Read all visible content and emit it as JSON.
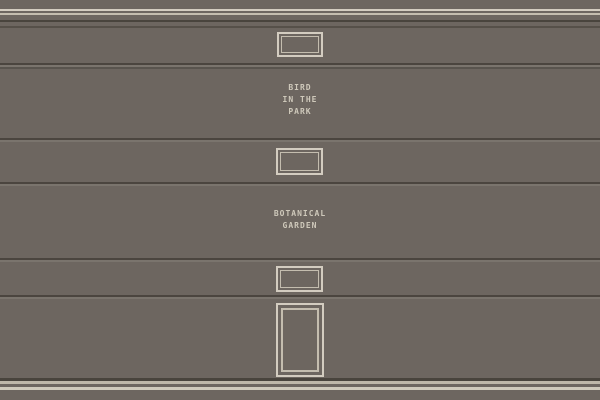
{
  "scene": {
    "description": "pixel-art building facade wall with windows, door and painted signs"
  },
  "signs": {
    "bird": {
      "lines": [
        "BIRD",
        "IN THE",
        "PARK"
      ]
    },
    "garden": {
      "lines": [
        "BOTANICAL",
        "GARDEN"
      ]
    }
  },
  "objects": {
    "window_top": "window-frame",
    "window_middle": "window-frame",
    "window_lower": "window-frame",
    "door": "entrance-door"
  },
  "colors": {
    "wall": "#6d6660",
    "trim_light": "#d3ccc0",
    "trim_mid": "#c4bdaf",
    "line_dark": "#49443d",
    "line_shadow": "#565049",
    "seam_dark": "#4b453f",
    "seam_light": "#7a746d",
    "base_light_1": "#beb7a9",
    "base_light_2": "#cfc9bb",
    "sign_text": "#cfc9bb"
  }
}
